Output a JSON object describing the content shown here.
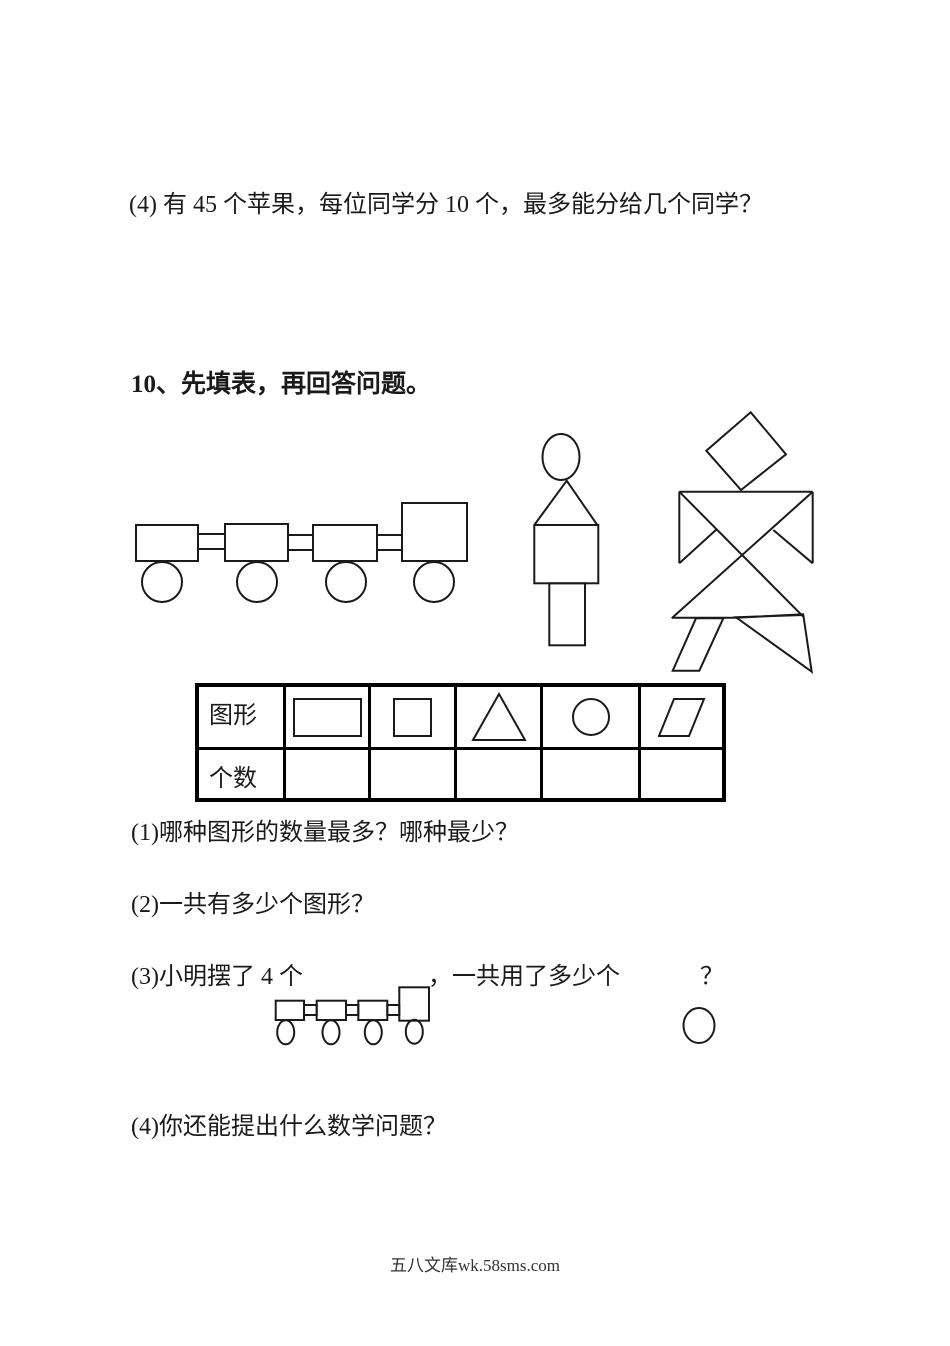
{
  "ink_color": "#1a1a1a",
  "top_question": "(4) 有 45 个苹果，每位同学分 10 个，最多能分给几个同学？",
  "section": {
    "heading": "10、先填表，再回答问题。"
  },
  "figures": {
    "train": "train-made-of-shapes",
    "person": "person-made-of-shapes",
    "windmill": "tangram-person-figure",
    "small_train": "small-train-of-shapes",
    "circle": "circle-shape"
  },
  "table": {
    "row1_header": "图形",
    "row2_header": "个数",
    "shapes": [
      "rectangle",
      "square",
      "triangle",
      "circle",
      "parallelogram"
    ],
    "counts": [
      "",
      "",
      "",
      "",
      ""
    ]
  },
  "questions": {
    "q1": "(1)哪种图形的数量最多？哪种最少？",
    "q2": "(2)一共有多少个图形？",
    "q3_before": "(3)小明摆了 4 个",
    "q3_after": "，一共用了多少个",
    "q3_mark": "？",
    "q4": "(4)你还能提出什么数学问题？"
  },
  "footer": {
    "text": "五八文库wk.58sms.com"
  }
}
